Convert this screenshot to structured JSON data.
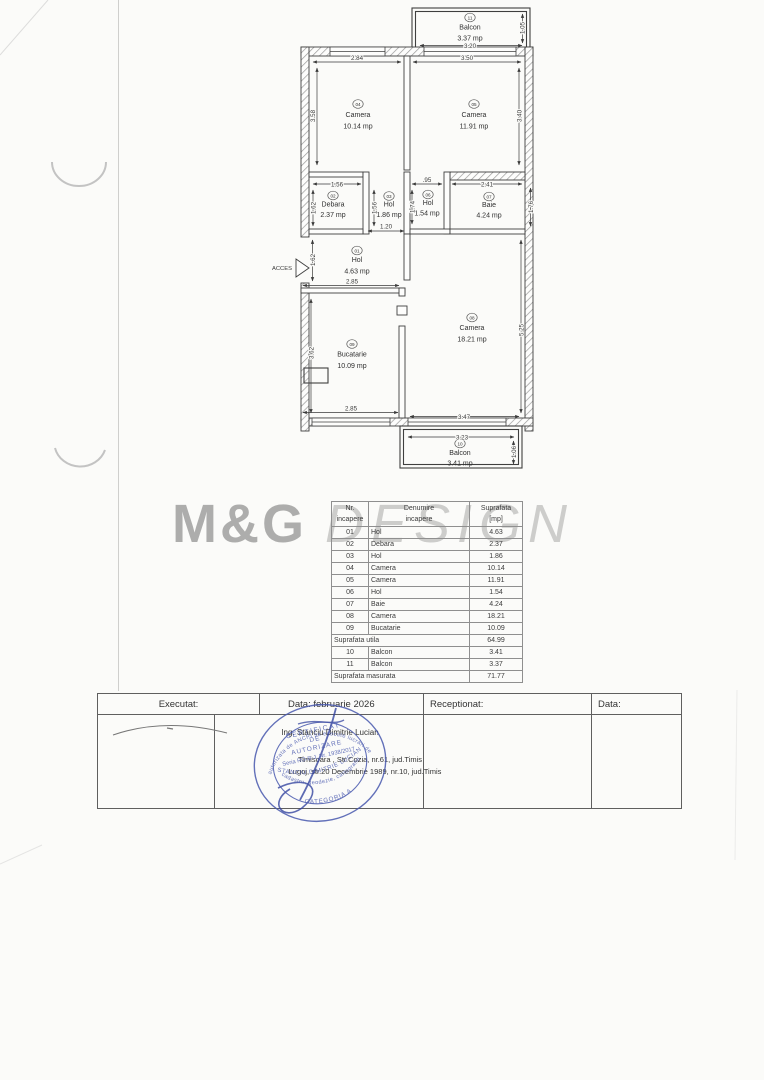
{
  "watermark": {
    "part1": "M&G",
    "part2": "DESIGN"
  },
  "plan": {
    "acces": "ACCES",
    "rooms": [
      {
        "num": "01",
        "name": "Hol",
        "area": "4.63 mp"
      },
      {
        "num": "02",
        "name": "Debara",
        "area": "2.37 mp"
      },
      {
        "num": "03",
        "name": "Hol",
        "area": "1.86 mp"
      },
      {
        "num": "04",
        "name": "Camera",
        "area": "10.14 mp"
      },
      {
        "num": "05",
        "name": "Camera",
        "area": "11.91 mp"
      },
      {
        "num": "06",
        "name": "Hol",
        "area": "1.54 mp"
      },
      {
        "num": "07",
        "name": "Baie",
        "area": "4.24 mp"
      },
      {
        "num": "08",
        "name": "Camera",
        "area": "18.21 mp"
      },
      {
        "num": "09",
        "name": "Bucatarie",
        "area": "10.09 mp"
      },
      {
        "num": "10",
        "name": "Balcon",
        "area": "3.41 mp"
      },
      {
        "num": "11",
        "name": "Balcon",
        "area": "3.37 mp"
      }
    ],
    "dims": {
      "balcony_w": "3.20",
      "balcony_h": "1.05",
      "r04_w": "2.84",
      "r05_w": "3.50",
      "r04_h": "3.58",
      "r05_h": "3.40",
      "debara_w": "1.56",
      "debara_h": "1.62",
      "hol03_h": "1.56",
      "hol03_door": "1.20",
      "hol06_w": ".95",
      "hol06_h": "1.74",
      "baie_w": "2.41",
      "baie_h": "1.76",
      "entry_h": "1.62",
      "hol01_w": "2.85",
      "buc_h": "3.62",
      "cam08_h": "5.25",
      "buc_w": "2.85",
      "cam08_w": "3.47",
      "balc10_w": "3.23",
      "balc10_h": "1.06"
    }
  },
  "table": {
    "header": {
      "c1a": "Nr.",
      "c1b": "incapere",
      "c2a": "Denumire",
      "c2b": "incapere",
      "c3a": "Suprafata",
      "c3b": "[mp]"
    },
    "rows": [
      [
        "01",
        "Hol",
        "4.63"
      ],
      [
        "02",
        "Debara",
        "2.37"
      ],
      [
        "03",
        "Hol",
        "1.86"
      ],
      [
        "04",
        "Camera",
        "10.14"
      ],
      [
        "05",
        "Camera",
        "11.91"
      ],
      [
        "06",
        "Hol",
        "1.54"
      ],
      [
        "07",
        "Baie",
        "4.24"
      ],
      [
        "08",
        "Camera",
        "18.21"
      ],
      [
        "09",
        "Bucatarie",
        "10.09"
      ]
    ],
    "utila_label": "Suprafata utila",
    "utila_value": "64.99",
    "rows2": [
      [
        "10",
        "Balcon",
        "3.41"
      ],
      [
        "11",
        "Balcon",
        "3.37"
      ]
    ],
    "masurata_label": "Suprafata masurata",
    "masurata_value": "71.77"
  },
  "titleblock": {
    "executat": "Executat:",
    "data1": "Data: februarie 2026",
    "receptionat": "Receptionat:",
    "data2": "Data:",
    "engineer": "Ing. Stanciu Dimitrie Lucian",
    "address1": "Timisoara , Str.Cozia, nr.61, jud.Timis",
    "address2": "Lugoj, str.20 Decembrie 1989, nr.10, jud.Timis"
  },
  "stamp": {
    "ring_top": "autorizata de ANCPI sa execute lucrari de",
    "ring_bottom": "cadastru, geodezie, cartografie",
    "line1": "CERTIFICAT",
    "line2": "DE",
    "line3": "AUTORIZARE",
    "serial": "Seria RO-B-J, Nr. 1938/2017",
    "name": "STANCIU DIMITRIE LUCIAN",
    "category": "CATEGORIA A",
    "blue": "#4858ae"
  }
}
